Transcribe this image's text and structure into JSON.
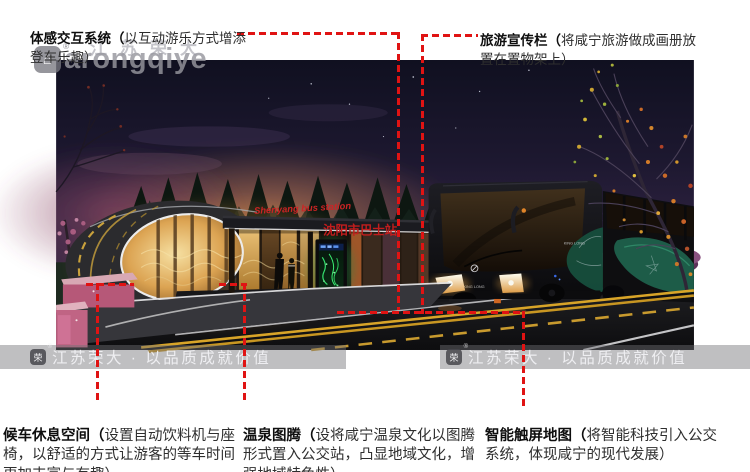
{
  "callout_labels": {
    "top_left": {
      "head": "体感交互系统（",
      "body": "以互动游乐方式增添\n登车乐趣）"
    },
    "top_right": {
      "head": "旅游宣传栏（",
      "body": "将咸宁旅游做成画册放\n置在置物架上）"
    },
    "bottom_left": {
      "head": "候车休息空间（",
      "body": "设置自动饮料机与座\n椅，以舒适的方式让游客的等车时间\n更加丰富与有趣）"
    },
    "bottom_middle": {
      "head": "温泉图腾（",
      "body": "设将咸宁温泉文化以图腾\n形式置入公交站，凸显地域文化，增\n强地域特色性）"
    },
    "bottom_right": {
      "head": "智能触屏地图（",
      "body": "将智能科技引入公交\n系统，体现咸宁的现代发展）"
    }
  },
  "scene": {
    "sign_en": "Shenyang bus station",
    "sign_zh": "沈阳市巴士站",
    "bus_brand": "KING LONG"
  },
  "watermarks": {
    "corner_text": "arongqiye",
    "corner_cn": "江苏荣大",
    "bar_text": "江苏荣大 · 以品质成就价值",
    "badge_glyph": "荣",
    "registered_mark": "®"
  },
  "colors": {
    "callout_red": "#e01313",
    "sign_red": "#c42020",
    "kiosk_green": "#35e06e",
    "station_gold": "#e8bd6e",
    "sky_navy": "#141428"
  }
}
